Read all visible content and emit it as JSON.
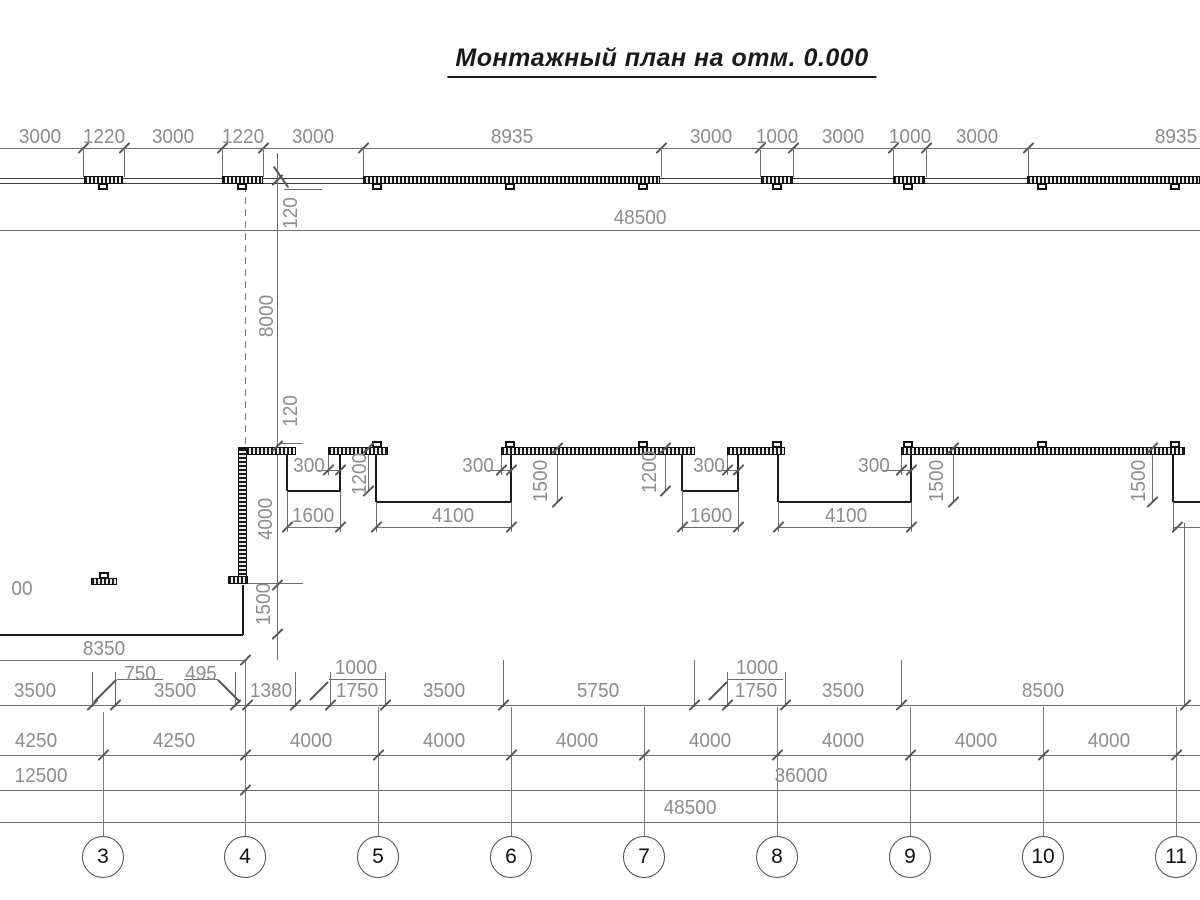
{
  "title": {
    "text": "Монтажный план на отм. 0.000"
  },
  "colors": {
    "dim_line": "#6e6e6e",
    "wall_line": "#3d3d3d",
    "outline": "#1c1c1c",
    "axis_line": "#7a7a7a",
    "dim_text": "#8d8d8d",
    "title_text": "#1a1a1a",
    "wall_fill": "#1c1c1c"
  },
  "dimension_labels": [
    {
      "t": "3000",
      "x": 40,
      "y": 137
    },
    {
      "t": "1220",
      "x": 104,
      "y": 137
    },
    {
      "t": "3000",
      "x": 173,
      "y": 137
    },
    {
      "t": "1220",
      "x": 243,
      "y": 137
    },
    {
      "t": "3000",
      "x": 313,
      "y": 137
    },
    {
      "t": "8935",
      "x": 512,
      "y": 137
    },
    {
      "t": "3000",
      "x": 711,
      "y": 137
    },
    {
      "t": "1000",
      "x": 777,
      "y": 137
    },
    {
      "t": "3000",
      "x": 843,
      "y": 137
    },
    {
      "t": "1000",
      "x": 910,
      "y": 137
    },
    {
      "t": "3000",
      "x": 977,
      "y": 137
    },
    {
      "t": "8935",
      "x": 1176,
      "y": 137
    },
    {
      "t": "48500",
      "x": 640,
      "y": 218
    },
    {
      "t": "120",
      "x": 291,
      "y": 213,
      "r": 1
    },
    {
      "t": "8000",
      "x": 267,
      "y": 316,
      "r": 1
    },
    {
      "t": "120",
      "x": 291,
      "y": 411,
      "r": 1
    },
    {
      "t": "4000",
      "x": 266,
      "y": 519,
      "r": 1
    },
    {
      "t": "1500",
      "x": 264,
      "y": 604,
      "r": 1
    },
    {
      "t": "300",
      "x": 309,
      "y": 466
    },
    {
      "t": "1200",
      "x": 360,
      "y": 474,
      "r": 1
    },
    {
      "t": "300",
      "x": 478,
      "y": 466
    },
    {
      "t": "1500",
      "x": 541,
      "y": 481,
      "r": 1
    },
    {
      "t": "1200",
      "x": 650,
      "y": 472,
      "r": 1
    },
    {
      "t": "300",
      "x": 709,
      "y": 466
    },
    {
      "t": "300",
      "x": 874,
      "y": 466
    },
    {
      "t": "1500",
      "x": 937,
      "y": 481,
      "r": 1
    },
    {
      "t": "1500",
      "x": 1139,
      "y": 481,
      "r": 1
    },
    {
      "t": "1600",
      "x": 313,
      "y": 516
    },
    {
      "t": "4100",
      "x": 453,
      "y": 516
    },
    {
      "t": "1600",
      "x": 711,
      "y": 516
    },
    {
      "t": "4100",
      "x": 846,
      "y": 516
    },
    {
      "t": "00",
      "x": 22,
      "y": 589
    },
    {
      "t": "8350",
      "x": 104,
      "y": 649
    },
    {
      "t": "3500",
      "x": 35,
      "y": 691
    },
    {
      "t": "750",
      "x": 140,
      "y": 674
    },
    {
      "t": "3500",
      "x": 175,
      "y": 691
    },
    {
      "t": "495",
      "x": 201,
      "y": 674
    },
    {
      "t": "1380",
      "x": 271,
      "y": 691
    },
    {
      "t": "1000",
      "x": 356,
      "y": 668
    },
    {
      "t": "1750",
      "x": 357,
      "y": 691
    },
    {
      "t": "3500",
      "x": 444,
      "y": 691
    },
    {
      "t": "5750",
      "x": 598,
      "y": 691
    },
    {
      "t": "1000",
      "x": 757,
      "y": 668
    },
    {
      "t": "1750",
      "x": 756,
      "y": 691
    },
    {
      "t": "3500",
      "x": 843,
      "y": 691
    },
    {
      "t": "8500",
      "x": 1043,
      "y": 691
    },
    {
      "t": "4250",
      "x": 36,
      "y": 741
    },
    {
      "t": "4250",
      "x": 174,
      "y": 741
    },
    {
      "t": "4000",
      "x": 311,
      "y": 741
    },
    {
      "t": "4000",
      "x": 444,
      "y": 741
    },
    {
      "t": "4000",
      "x": 577,
      "y": 741
    },
    {
      "t": "4000",
      "x": 710,
      "y": 741
    },
    {
      "t": "4000",
      "x": 843,
      "y": 741
    },
    {
      "t": "4000",
      "x": 976,
      "y": 741
    },
    {
      "t": "4000",
      "x": 1109,
      "y": 741
    },
    {
      "t": "12500",
      "x": 41,
      "y": 776
    },
    {
      "t": "36000",
      "x": 801,
      "y": 776
    },
    {
      "t": "48500",
      "x": 690,
      "y": 808
    }
  ],
  "hlines": [
    [
      0,
      1200,
      148,
      "dim"
    ],
    [
      0,
      1200,
      178,
      "wall"
    ],
    [
      0,
      1200,
      183,
      "wall"
    ],
    [
      0,
      1200,
      230,
      "dim"
    ],
    [
      0,
      1200,
      705,
      "dim"
    ],
    [
      0,
      1200,
      755,
      "dim"
    ],
    [
      0,
      1200,
      790,
      "dim"
    ],
    [
      0,
      1200,
      822,
      "dim"
    ],
    [
      0,
      245,
      660,
      "dim"
    ],
    [
      0,
      243,
      635,
      "dark"
    ],
    [
      287,
      340,
      491,
      "dark"
    ],
    [
      376,
      511,
      502,
      "dark"
    ],
    [
      682,
      738,
      491,
      "dark"
    ],
    [
      778,
      911,
      502,
      "dark"
    ],
    [
      1173,
      1200,
      502,
      "dark"
    ],
    [
      287,
      340,
      527,
      "dim"
    ],
    [
      376,
      511,
      527,
      "dim"
    ],
    [
      682,
      738,
      527,
      "dim"
    ],
    [
      778,
      911,
      527,
      "dim"
    ],
    [
      1173,
      1200,
      527,
      "dim"
    ],
    [
      284,
      322,
      189,
      "dim"
    ],
    [
      280,
      303,
      443,
      "dim"
    ],
    [
      247,
      303,
      583,
      "dim"
    ],
    [
      117,
      163,
      679,
      "dim"
    ],
    [
      184,
      218,
      679,
      "dim"
    ],
    [
      329,
      385,
      679,
      "dim"
    ],
    [
      727,
      783,
      679,
      "dim"
    ],
    [
      317,
      340,
      470,
      "dim"
    ],
    [
      487,
      511,
      470,
      "dim"
    ],
    [
      717,
      738,
      470,
      "dim"
    ],
    [
      883,
      911,
      470,
      "dim"
    ]
  ],
  "vlines": [
    [
      83,
      150,
      177,
      "dim"
    ],
    [
      124,
      150,
      177,
      "dim"
    ],
    [
      222,
      150,
      177,
      "dim"
    ],
    [
      263,
      150,
      177,
      "dim"
    ],
    [
      363,
      150,
      177,
      "dim"
    ],
    [
      661,
      150,
      177,
      "dim"
    ],
    [
      760,
      150,
      177,
      "dim"
    ],
    [
      793,
      150,
      177,
      "dim"
    ],
    [
      893,
      150,
      177,
      "dim"
    ],
    [
      926,
      150,
      177,
      "dim"
    ],
    [
      1028,
      150,
      177,
      "dim"
    ],
    [
      277,
      153,
      660,
      "dim"
    ],
    [
      245,
      185,
      446,
      "dash"
    ],
    [
      287,
      455,
      491,
      "dark"
    ],
    [
      340,
      455,
      491,
      "dark"
    ],
    [
      376,
      455,
      502,
      "dark"
    ],
    [
      511,
      455,
      502,
      "dark"
    ],
    [
      682,
      455,
      491,
      "dark"
    ],
    [
      738,
      455,
      491,
      "dark"
    ],
    [
      778,
      455,
      502,
      "dark"
    ],
    [
      911,
      455,
      502,
      "dark"
    ],
    [
      1173,
      455,
      502,
      "dark"
    ],
    [
      243,
      585,
      635,
      "dark"
    ],
    [
      287,
      491,
      532,
      "dim"
    ],
    [
      340,
      491,
      532,
      "dim"
    ],
    [
      376,
      502,
      532,
      "dim"
    ],
    [
      511,
      502,
      532,
      "dim"
    ],
    [
      682,
      491,
      532,
      "dim"
    ],
    [
      738,
      491,
      532,
      "dim"
    ],
    [
      778,
      502,
      532,
      "dim"
    ],
    [
      911,
      502,
      532,
      "dim"
    ],
    [
      1173,
      502,
      532,
      "dim"
    ],
    [
      368,
      448,
      491,
      "dim"
    ],
    [
      557,
      448,
      502,
      "dim"
    ],
    [
      665,
      448,
      491,
      "dim"
    ],
    [
      953,
      448,
      502,
      "dim"
    ],
    [
      1152,
      448,
      502,
      "dim"
    ],
    [
      328,
      455,
      475,
      "dim"
    ],
    [
      501,
      455,
      475,
      "dim"
    ],
    [
      727,
      455,
      475,
      "dim"
    ],
    [
      901,
      455,
      475,
      "dim"
    ],
    [
      92,
      672,
      707,
      "dim"
    ],
    [
      115,
      672,
      707,
      "dim"
    ],
    [
      235,
      672,
      707,
      "dim"
    ],
    [
      295,
      672,
      707,
      "dim"
    ],
    [
      330,
      672,
      707,
      "dim"
    ],
    [
      385,
      672,
      707,
      "dim"
    ],
    [
      503,
      660,
      707,
      "dim"
    ],
    [
      694,
      660,
      707,
      "dim"
    ],
    [
      727,
      672,
      707,
      "dim"
    ],
    [
      785,
      672,
      707,
      "dim"
    ],
    [
      901,
      660,
      707,
      "dim"
    ],
    [
      1184,
      523,
      707,
      "dim"
    ],
    [
      103,
      712,
      836,
      "thin"
    ],
    [
      245,
      660,
      836,
      "thin"
    ],
    [
      378,
      707,
      836,
      "thin"
    ],
    [
      511,
      707,
      836,
      "thin"
    ],
    [
      644,
      707,
      836,
      "thin"
    ],
    [
      777,
      707,
      836,
      "thin"
    ],
    [
      910,
      707,
      836,
      "thin"
    ],
    [
      1043,
      707,
      836,
      "thin"
    ],
    [
      1176,
      707,
      836,
      "thin"
    ]
  ],
  "ticks": [
    [
      83,
      148
    ],
    [
      124,
      148
    ],
    [
      222,
      148
    ],
    [
      263,
      148
    ],
    [
      363,
      148
    ],
    [
      661,
      148
    ],
    [
      760,
      148
    ],
    [
      793,
      148
    ],
    [
      893,
      148
    ],
    [
      926,
      148
    ],
    [
      1028,
      148
    ],
    [
      277,
      180
    ],
    [
      277,
      446
    ],
    [
      277,
      585
    ],
    [
      277,
      634
    ],
    [
      328,
      470
    ],
    [
      340,
      470
    ],
    [
      501,
      470
    ],
    [
      511,
      470
    ],
    [
      727,
      470
    ],
    [
      738,
      470
    ],
    [
      901,
      470
    ],
    [
      911,
      470
    ],
    [
      368,
      448
    ],
    [
      368,
      491
    ],
    [
      557,
      448
    ],
    [
      557,
      502
    ],
    [
      665,
      448
    ],
    [
      665,
      491
    ],
    [
      953,
      448
    ],
    [
      953,
      502
    ],
    [
      1152,
      448
    ],
    [
      1152,
      502
    ],
    [
      287,
      527
    ],
    [
      340,
      527
    ],
    [
      376,
      527
    ],
    [
      511,
      527
    ],
    [
      682,
      527
    ],
    [
      738,
      527
    ],
    [
      778,
      527
    ],
    [
      911,
      527
    ],
    [
      1177,
      527
    ],
    [
      245,
      660
    ],
    [
      92,
      705
    ],
    [
      115,
      705
    ],
    [
      235,
      705
    ],
    [
      247,
      705
    ],
    [
      295,
      705
    ],
    [
      330,
      705
    ],
    [
      385,
      705
    ],
    [
      503,
      705
    ],
    [
      694,
      705
    ],
    [
      727,
      705
    ],
    [
      785,
      705
    ],
    [
      901,
      705
    ],
    [
      1185,
      705
    ],
    [
      103,
      755
    ],
    [
      245,
      755
    ],
    [
      378,
      755
    ],
    [
      511,
      755
    ],
    [
      644,
      755
    ],
    [
      777,
      755
    ],
    [
      910,
      755
    ],
    [
      1043,
      755
    ],
    [
      1176,
      755
    ],
    [
      245,
      790
    ],
    [
      105,
      691,
      32,
      -45
    ],
    [
      229,
      691,
      32,
      45
    ],
    [
      319,
      691,
      26,
      -45
    ],
    [
      718,
      691,
      26,
      -45
    ],
    [
      281,
      177,
      26,
      55
    ]
  ],
  "walls": {
    "top_row": {
      "bar_y": 176,
      "bar_h": 8,
      "tab_side": "below",
      "bars": [
        {
          "x1": 84,
          "x2": 123,
          "tabs": [
            103
          ]
        },
        {
          "x1": 222,
          "x2": 263,
          "tabs": [
            242
          ]
        },
        {
          "x1": 363,
          "x2": 660,
          "tabs": [
            377,
            510,
            643
          ]
        },
        {
          "x1": 761,
          "x2": 793,
          "tabs": [
            777
          ]
        },
        {
          "x1": 893,
          "x2": 925,
          "tabs": [
            908
          ]
        },
        {
          "x1": 1027,
          "x2": 1200,
          "tabs": [
            1042,
            1175
          ]
        }
      ]
    },
    "mid_row": {
      "bar_y": 447,
      "bar_h": 8,
      "tab_side": "above",
      "bars": [
        {
          "x1": 238,
          "x2": 296,
          "tabs": []
        },
        {
          "x1": 328,
          "x2": 388,
          "tabs": [
            377
          ]
        },
        {
          "x1": 501,
          "x2": 695,
          "tabs": [
            510,
            643
          ]
        },
        {
          "x1": 727,
          "x2": 785,
          "tabs": [
            777
          ]
        },
        {
          "x1": 901,
          "x2": 1185,
          "tabs": [
            908,
            1042,
            1175
          ]
        }
      ]
    },
    "vertical_wall": {
      "x": 238,
      "y": 448,
      "w": 9,
      "h": 136
    },
    "foot": {
      "x": 228,
      "y": 576,
      "w": 20,
      "h": 8
    },
    "small_element": {
      "x": 91,
      "y": 578,
      "w": 26,
      "h": 7,
      "tab_x": 104
    }
  },
  "axes": {
    "labels": [
      "3",
      "4",
      "5",
      "6",
      "7",
      "8",
      "9",
      "10",
      "11"
    ],
    "x": [
      103,
      245,
      378,
      511,
      644,
      777,
      910,
      1043,
      1176
    ],
    "circle_y": 857,
    "radius": 21
  }
}
